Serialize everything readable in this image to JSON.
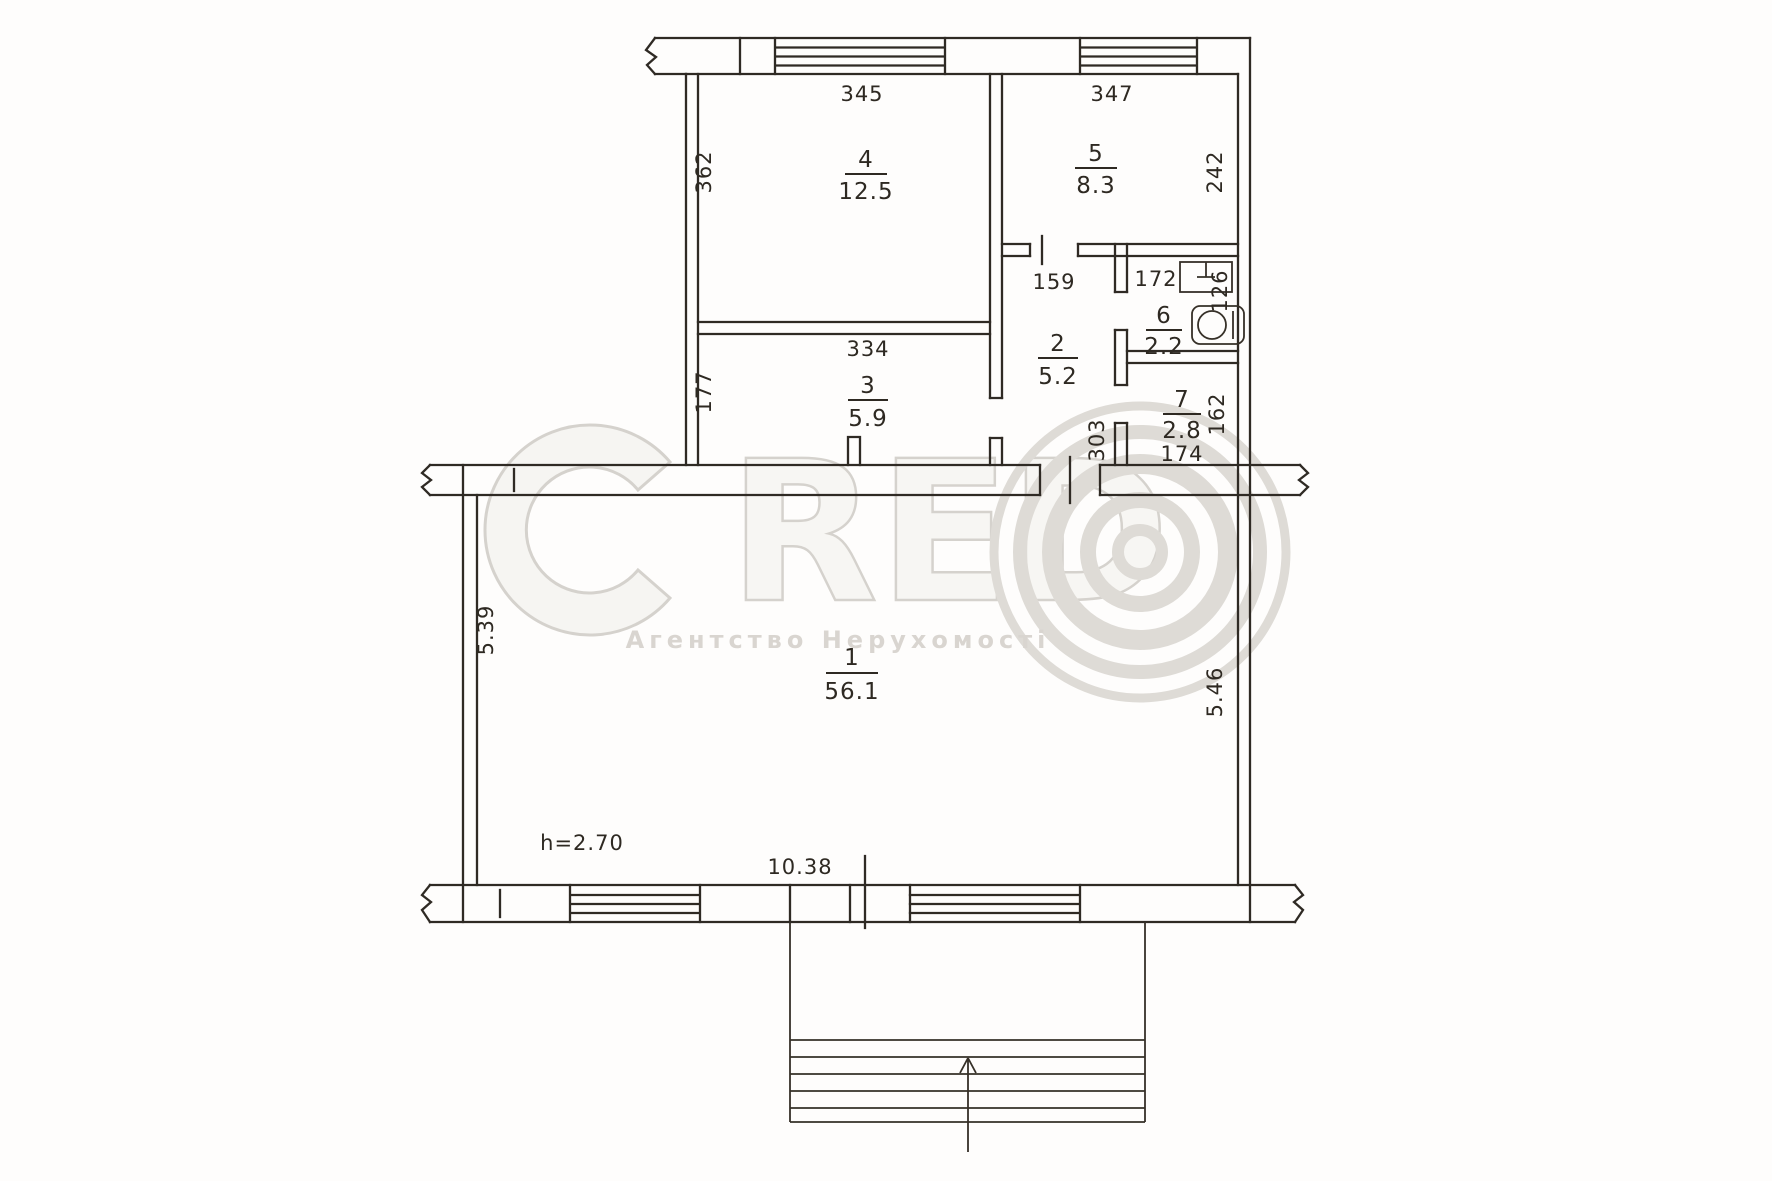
{
  "watermark": {
    "letters": {
      "c": "C",
      "r": "R",
      "e": "E",
      "d": "D"
    },
    "subtitle": "Агентство Нерухомості"
  },
  "rooms": {
    "r1": {
      "number": "1",
      "area": "56.1"
    },
    "r2": {
      "number": "2",
      "area": "5.2"
    },
    "r3": {
      "number": "3",
      "area": "5.9"
    },
    "r4": {
      "number": "4",
      "area": "12.5"
    },
    "r5": {
      "number": "5",
      "area": "8.3"
    },
    "r6": {
      "number": "6",
      "area": "2.2"
    },
    "r7": {
      "number": "7",
      "area": "2.8"
    }
  },
  "dimensions": {
    "room4_width": "345",
    "room4_depth": "362",
    "room5_width": "347",
    "room5_depth": "242",
    "room3_width": "334",
    "room3_depth": "177",
    "hallway_width": "159",
    "hallway_depth": "303",
    "bathroom_width": "172",
    "bathroom_depth": "126",
    "room7_depth": "162",
    "room7_width": "174",
    "room1_left": "5.39",
    "room1_right": "5.46",
    "room1_width": "10.38",
    "ceiling_height": "h=2.70"
  },
  "colors": {
    "line": "#2f2a24",
    "watermark": "#d9d5d0",
    "paper": "#fefdfc"
  }
}
